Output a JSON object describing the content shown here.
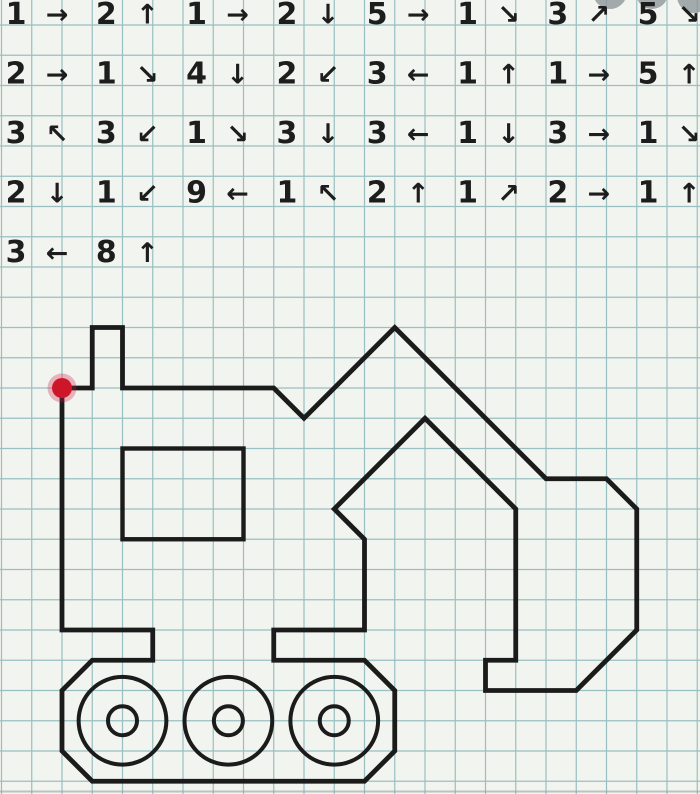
{
  "canvas": {
    "width": 700,
    "height": 794,
    "cell_px": 30.25,
    "origin_px": {
      "x": 62,
      "y": 388
    }
  },
  "grid": {
    "paper_color": "#f2f4ef",
    "line_color": "#82b2b6"
  },
  "instructions": {
    "text_color": "#1d1d1d",
    "rows": [
      [
        {
          "count": "1",
          "arrow": "→"
        },
        {
          "count": "2",
          "arrow": "↑"
        },
        {
          "count": "1",
          "arrow": "→"
        },
        {
          "count": "2",
          "arrow": "↓"
        },
        {
          "count": "5",
          "arrow": "→"
        },
        {
          "count": "1",
          "arrow": "↘"
        },
        {
          "count": "3",
          "arrow": "↗"
        },
        {
          "count": "5",
          "arrow": "↘"
        }
      ],
      [
        {
          "count": "2",
          "arrow": "→"
        },
        {
          "count": "1",
          "arrow": "↘"
        },
        {
          "count": "4",
          "arrow": "↓"
        },
        {
          "count": "2",
          "arrow": "↙"
        },
        {
          "count": "3",
          "arrow": "←"
        },
        {
          "count": "1",
          "arrow": "↑"
        },
        {
          "count": "1",
          "arrow": "→"
        },
        {
          "count": "5",
          "arrow": "↑"
        }
      ],
      [
        {
          "count": "3",
          "arrow": "↖"
        },
        {
          "count": "3",
          "arrow": "↙"
        },
        {
          "count": "1",
          "arrow": "↘"
        },
        {
          "count": "3",
          "arrow": "↓"
        },
        {
          "count": "3",
          "arrow": "←"
        },
        {
          "count": "1",
          "arrow": "↓"
        },
        {
          "count": "3",
          "arrow": "→"
        },
        {
          "count": "1",
          "arrow": "↘"
        }
      ],
      [
        {
          "count": "2",
          "arrow": "↓"
        },
        {
          "count": "1",
          "arrow": "↙"
        },
        {
          "count": "9",
          "arrow": "←"
        },
        {
          "count": "1",
          "arrow": "↖"
        },
        {
          "count": "2",
          "arrow": "↑"
        },
        {
          "count": "1",
          "arrow": "↗"
        },
        {
          "count": "2",
          "arrow": "→"
        },
        {
          "count": "1",
          "arrow": "↑"
        }
      ],
      [
        {
          "count": "3",
          "arrow": "←"
        },
        {
          "count": "8",
          "arrow": "↑"
        }
      ]
    ]
  },
  "drawing": {
    "figure_label": "excavator",
    "line_color": "#1b1b1b",
    "start_dot": {
      "color": "#cd1728",
      "halo_color": "rgba(210,25,70,0.30)",
      "radius_px": 10
    },
    "window": {
      "col": 2,
      "row": 2,
      "width_cells": 4,
      "height_cells": 3
    },
    "wheels": {
      "row": 11,
      "cols": [
        2,
        5.5,
        9
      ],
      "outer_radius_cells": 1.45,
      "inner_radius_cells": 0.48
    }
  },
  "watermark": {
    "color": "#8e979a",
    "blobs": [
      {
        "cx": 610,
        "cy": -8,
        "r": 17
      },
      {
        "cx": 652,
        "cy": -7,
        "r": 16
      },
      {
        "cx": 694,
        "cy": -4,
        "r": 17
      }
    ]
  },
  "photo_edge": {
    "color": "#99a2a4",
    "y": 791.5
  }
}
